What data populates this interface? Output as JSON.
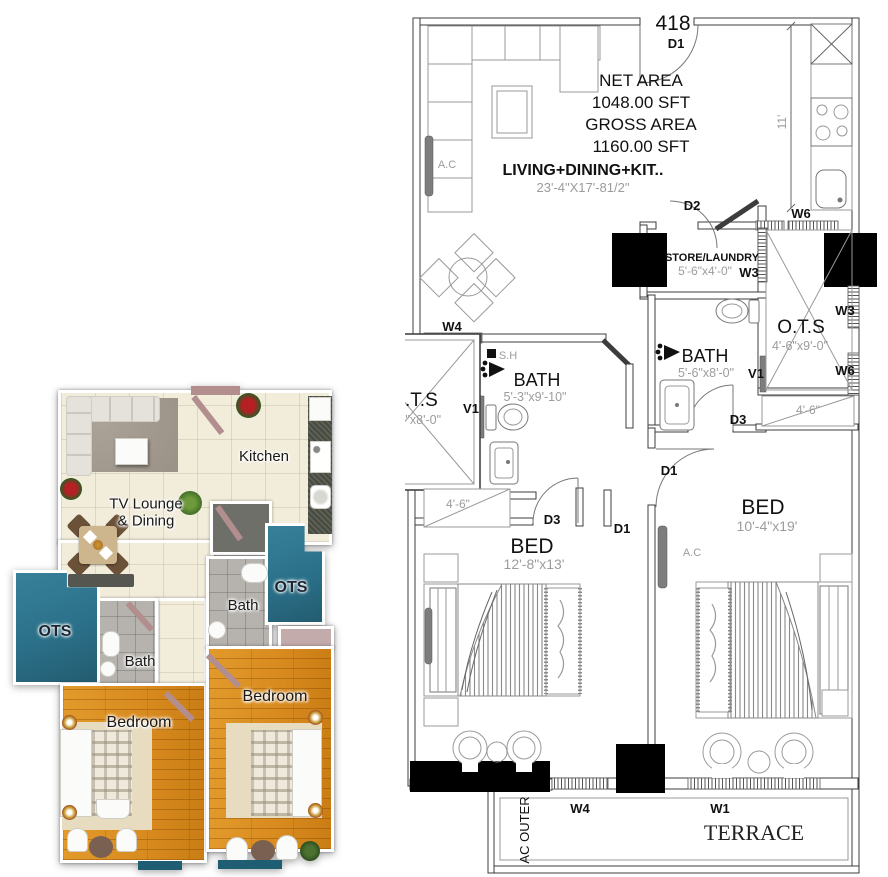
{
  "plan2d": {
    "unit_number": "418",
    "areas": {
      "net_label": "NET AREA",
      "net_value": "1048.00 SFT",
      "gross_label": "GROSS AREA",
      "gross_value": "1160.00 SFT"
    },
    "rooms": {
      "living": {
        "name": "LIVING+DINING+KIT..",
        "dims": "23'-4\"X17'-81/2\""
      },
      "store": {
        "name": "STORE/LAUNDRY",
        "dims": "5'-6\"x4'-0\""
      },
      "ots_right": {
        "name": "O.T.S",
        "dims": "4'-6\"x9'-0\""
      },
      "bath_right": {
        "name": "BATH",
        "dims": "5'-6\"x8'-0\""
      },
      "bath_center": {
        "name": "BATH",
        "dims": "5'-3\"x9'-10\""
      },
      "ots_center": {
        "name": "O.T.S",
        "dims": "7'-2\"x8'-0\""
      },
      "bed_left": {
        "name": "BED",
        "dims": "12'-8\"x13'"
      },
      "bed_right": {
        "name": "BED",
        "dims": "10'-4\"x19'"
      },
      "terrace": {
        "name": "TERRACE"
      },
      "ac_outer": {
        "name": "AC OUTER"
      }
    },
    "tags": {
      "d1": "D1",
      "d2": "D2",
      "d3": "D3",
      "v1": "V1",
      "w1": "W1",
      "w3": "W3",
      "w4": "W4",
      "w6": "W6",
      "sh": "S.H",
      "ac": "A.C"
    },
    "dims": {
      "eleven_ft": "11'",
      "four_six": "4'-6\""
    }
  },
  "plan3d": {
    "labels": {
      "kitchen": "Kitchen",
      "lounge_line1": "TV Lounge",
      "lounge_line2": "& Dining",
      "bath": "Bath",
      "ots": "OTS",
      "bedroom": "Bedroom"
    }
  },
  "colors": {
    "teal": "#2b7089",
    "teal_dark": "#1f5d72",
    "wood": "#d88a1e",
    "mauve": "#b38e8e",
    "mauve_light": "#c3abab",
    "cream": "#f2ecda",
    "tile": "#b6b3ae",
    "counter": "#474a3f",
    "rug": "#a09889",
    "dim": "#9c9c9c",
    "wall": "#000000"
  }
}
